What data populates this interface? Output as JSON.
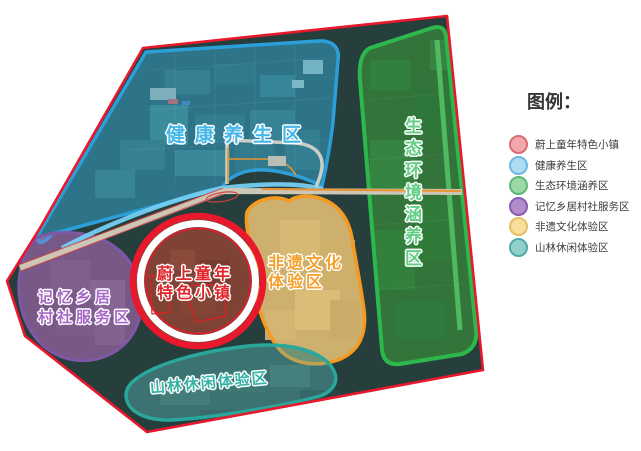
{
  "legend": {
    "title": "图例：",
    "items": [
      {
        "label": "蔚上童年特色小镇",
        "fill": "#f2a6ad",
        "stroke": "#d96b72"
      },
      {
        "label": "健康养生区",
        "fill": "#aedcf5",
        "stroke": "#6cb9e3"
      },
      {
        "label": "生态环境涵养区",
        "fill": "#9ad8a6",
        "stroke": "#5bb878"
      },
      {
        "label": "记忆乡居村社服务区",
        "fill": "#b28ccd",
        "stroke": "#8a5cb0"
      },
      {
        "label": "非遗文化体验区",
        "fill": "#f9dd9a",
        "stroke": "#e3c063"
      },
      {
        "label": "山林休闲体验区",
        "fill": "#8fd0cb",
        "stroke": "#4fa9a6"
      }
    ]
  },
  "map": {
    "boundary_color": "#e8192c",
    "zones": {
      "health": {
        "label": "健康养生区",
        "color": "#45b6e8"
      },
      "eco": {
        "label": "生态环境涵养区",
        "color": "#63cd84"
      },
      "town": {
        "line1": "蔚上童年",
        "line2": "特色小镇",
        "color": "#e0262a"
      },
      "memory": {
        "line1": "记忆乡居",
        "line2": "村社服务区",
        "color": "#a868c8"
      },
      "heritage": {
        "line1": "非遗文化",
        "line2": "体验区",
        "color": "#f5a02b"
      },
      "forest": {
        "label": "山林休闲体验区",
        "color": "#35b3a7"
      }
    }
  }
}
